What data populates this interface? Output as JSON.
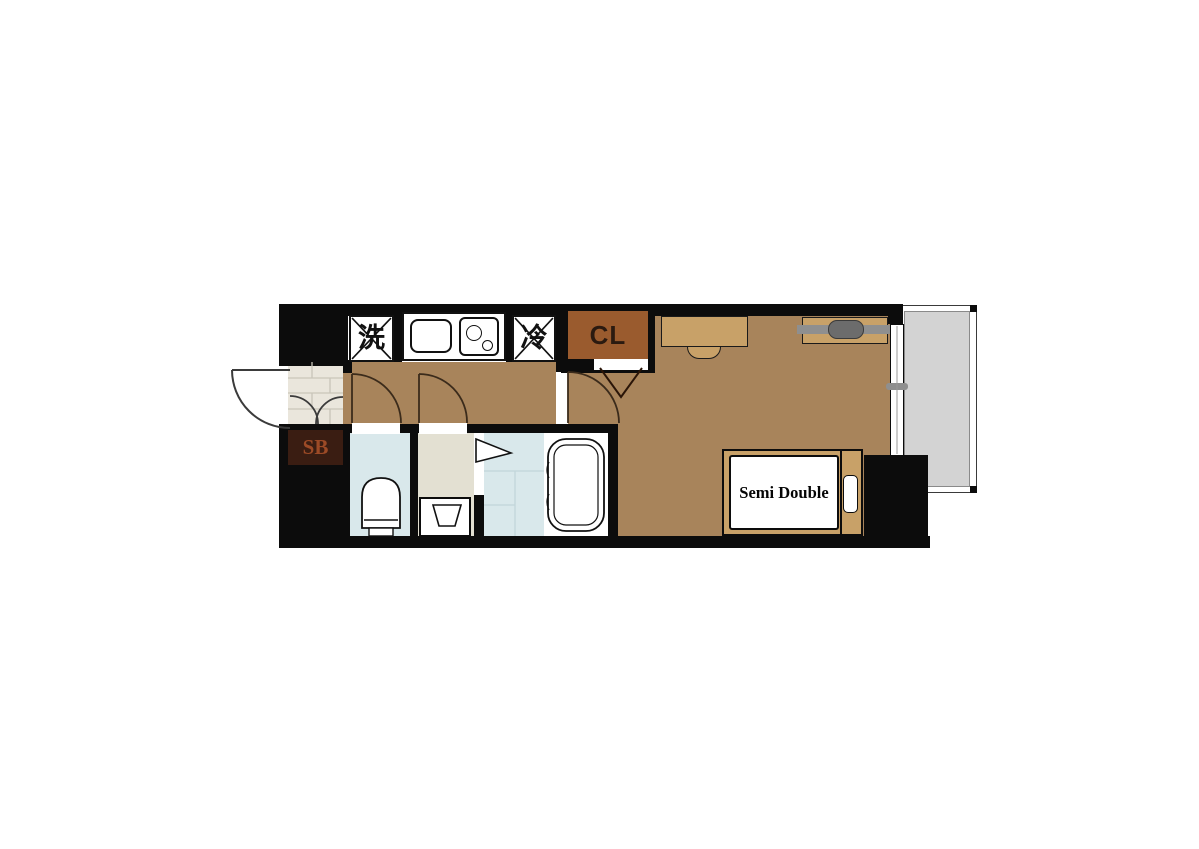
{
  "plan": {
    "type": "apartment-floor-plan",
    "labels": {
      "washing_machine": "洗",
      "refrigerator": "冷",
      "closet": "CL",
      "shoe_box": "SB",
      "bed": "Semi Double"
    },
    "fixtures": [
      "entry-door",
      "shoe-cabinet",
      "entrance-tile",
      "washing-machine-space",
      "kitchen-sink",
      "gas-stove",
      "refrigerator-space",
      "closet-folding-door",
      "hallway-door",
      "toilet",
      "toilet-door",
      "washbasin",
      "washroom-door",
      "bathroom-folding-door",
      "bathtub",
      "desk",
      "chair",
      "hanger-shelf",
      "semi-double-bed",
      "pillow",
      "sliding-window",
      "balcony"
    ],
    "colors": {
      "wall": "#0C0C0C",
      "wood_floor": "#A8845B",
      "furniture_tan": "#C8A168",
      "closet_brown": "#9A5B2E",
      "shoe_box_brown": "#3A1D12",
      "shoe_box_text": "#9C4A26",
      "entrance_tile": "#EAE6DC",
      "wet_room_blue": "#D9E8EB",
      "washroom_beige": "#E3E0D2",
      "balcony_gray": "#D3D3D3",
      "hanger_bar_gray": "#8F8F8F",
      "fixture_white": "#FFFFFF"
    }
  }
}
